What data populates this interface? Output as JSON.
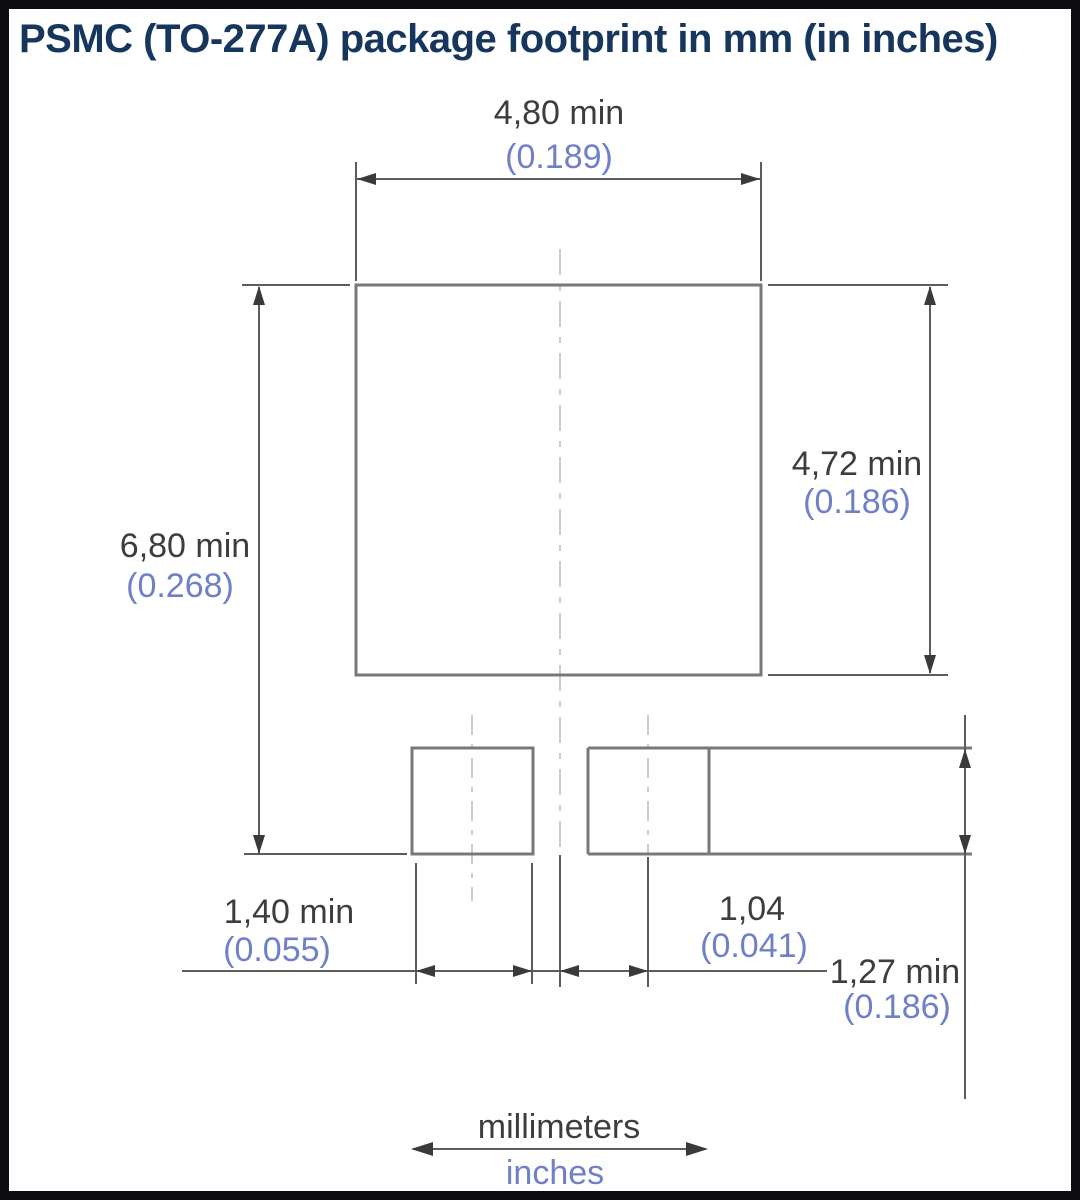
{
  "title": "PSMC (TO-277A) package footprint in mm (in inches)",
  "units_legend": {
    "millimeters_label": "millimeters",
    "inches_label": "inches"
  },
  "dimensions": {
    "footprint_width_top": {
      "mm": "4,80 min",
      "inch": "(0.189)"
    },
    "footprint_height_right": {
      "mm": "4,72 min",
      "inch": "(0.186)"
    },
    "overall_height_left": {
      "mm": "6,80 min",
      "inch": "(0.268)"
    },
    "small_pad_width": {
      "mm": "1,40 min",
      "inch": "(0.055)"
    },
    "center_offset": {
      "mm": "1,04",
      "inch": "(0.041)"
    },
    "small_pad_height": {
      "mm": "1,27 min",
      "inch": "(0.186)"
    }
  },
  "colors": {
    "title_text": "#17365d",
    "mm_text": "#3d3d40",
    "inch_text": "#7080c8",
    "outline_line": "#787878",
    "dimension_line": "#5c5c5c",
    "centerline": "#cccccc",
    "frame_border": "#0b0b10"
  }
}
